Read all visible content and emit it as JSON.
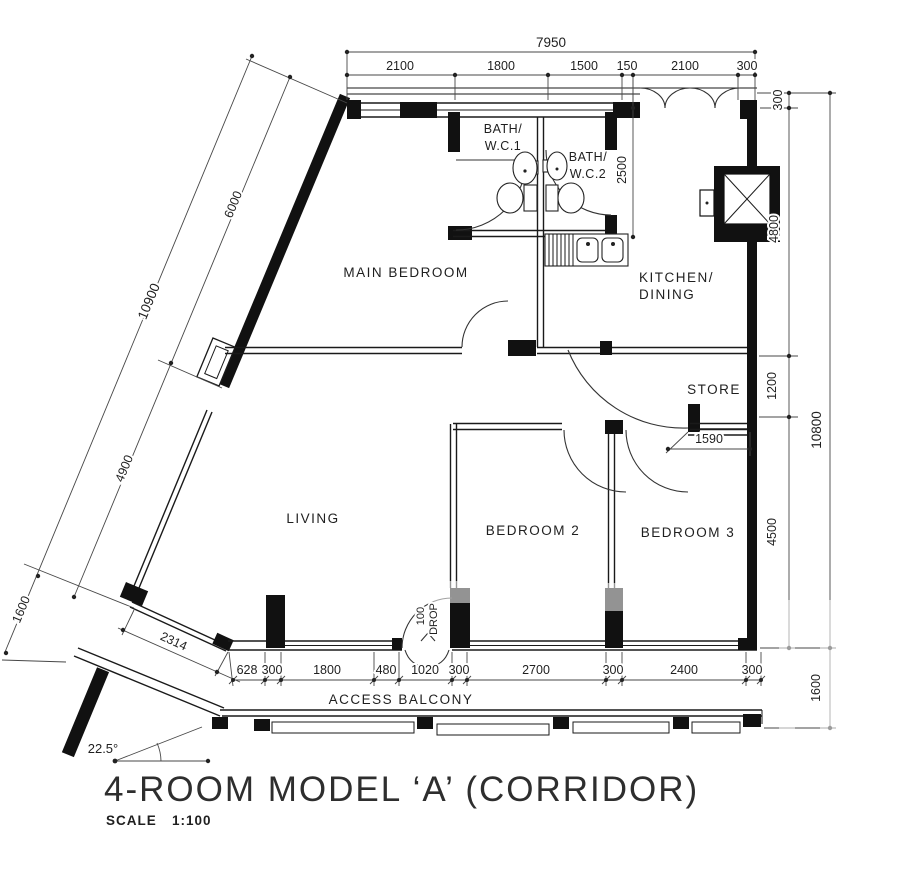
{
  "title": {
    "main": "4-ROOM MODEL ‘A’ (CORRIDOR)",
    "scale_label": "SCALE",
    "scale_value": "1:100"
  },
  "rooms": {
    "main_bedroom": "MAIN BEDROOM",
    "bath1_line1": "BATH/",
    "bath1_line2": "W.C.1",
    "bath2_line1": "BATH/",
    "bath2_line2": "W.C.2",
    "kitchen_line1": "KITCHEN/",
    "kitchen_line2": "DINING",
    "store": "STORE",
    "living": "LIVING",
    "bedroom2": "BEDROOM 2",
    "bedroom3": "BEDROOM 3",
    "access_balcony": "ACCESS BALCONY"
  },
  "annotations": {
    "drop_value": "100",
    "drop_word": "DROP",
    "angle": "22.5°"
  },
  "dimensions": {
    "top_total": "7950",
    "top": [
      "2100",
      "1800",
      "1500",
      "150",
      "2100",
      "300"
    ],
    "right": [
      "300",
      "4800",
      "1200",
      "4500"
    ],
    "right_total": "10800",
    "right_lower": "1600",
    "left": [
      "6000",
      "4900"
    ],
    "left_total": "10900",
    "left_lower": "1600",
    "slant": "2314",
    "bottom": [
      "628",
      "300",
      "1800",
      "480",
      "1020",
      "300",
      "2700",
      "300",
      "2400",
      "300"
    ],
    "store_width": "1590",
    "bath_depth": "2500"
  }
}
